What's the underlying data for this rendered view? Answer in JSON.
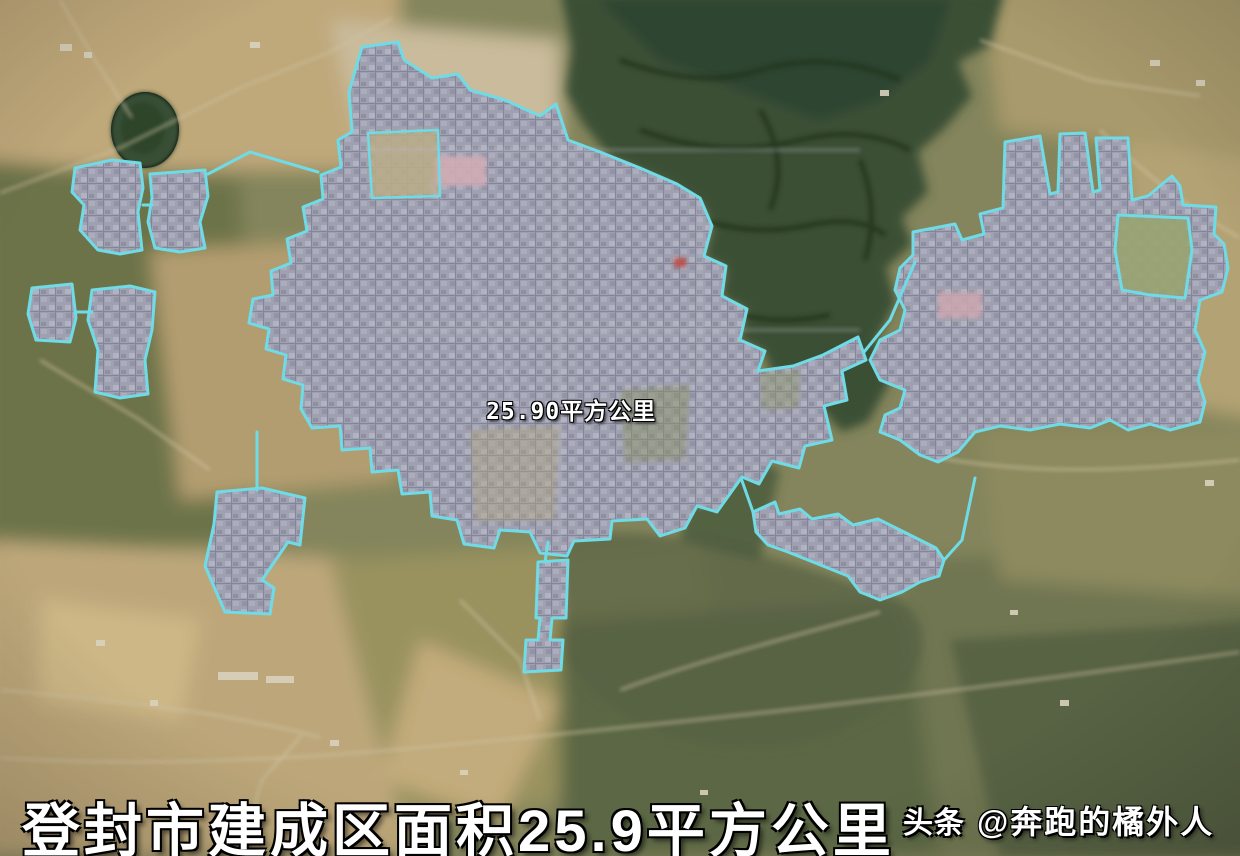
{
  "map": {
    "kind": "satellite-imagery",
    "area_label": "25.90平方公里",
    "boundary_color": "#6fdbe6",
    "urban_fill_color": "#a29ead",
    "regions": [
      "main-urban-area",
      "northwest-cluster-a",
      "northwest-cluster-b",
      "west-cluster",
      "west-small-block",
      "southwest-cluster",
      "south-annex",
      "southeast-cluster",
      "east-district"
    ]
  },
  "caption": {
    "title": "登封市建成区面积25.9平方公里",
    "text_color": "#ffffff"
  },
  "watermark": {
    "brand": "头条",
    "handle": "@奔跑的橘外人"
  }
}
